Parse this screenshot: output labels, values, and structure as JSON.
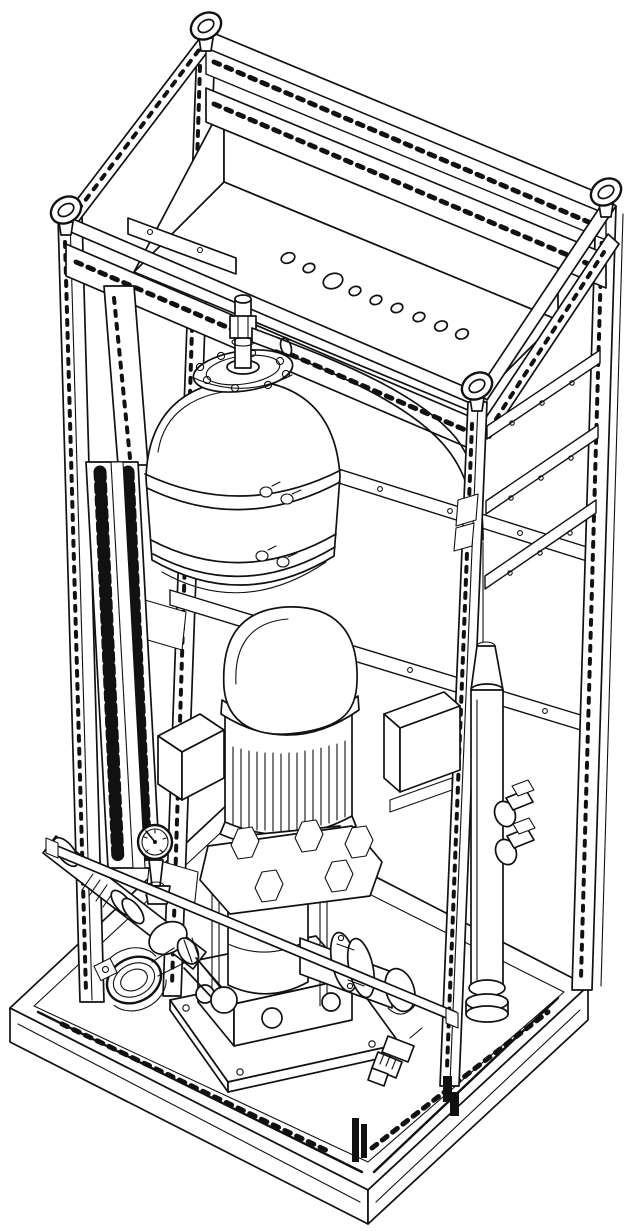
{
  "figure": {
    "aria_label": "Isometric patent-style line drawing of a skid-mounted vertical pump unit inside an open slotted-angle frame with a pressure tank, wiring duct, riser pipe and valves",
    "colors": {
      "background": "#ffffff",
      "line": "#111111"
    }
  },
  "parts": [
    "base-skid",
    "foundation-plate",
    "left-post",
    "rear-post",
    "right-post",
    "front-post",
    "top-frame",
    "lifting-eye",
    "cable-gland-tray",
    "gland-hole",
    "tank-support-bracket",
    "pressure-tank",
    "tank-strap-band",
    "tank-top-flange",
    "vent-hose",
    "wiring-duct",
    "rear-rail",
    "side-rail",
    "riser-pipe",
    "pipe-union",
    "electrical-box",
    "motor",
    "motor-junction-box",
    "pump-head",
    "pump-column",
    "pump-base",
    "suction-piping",
    "pressure-gauge",
    "clamp-coupling",
    "discharge-piping",
    "pipe-flange",
    "drain-valve",
    "front-brace"
  ]
}
